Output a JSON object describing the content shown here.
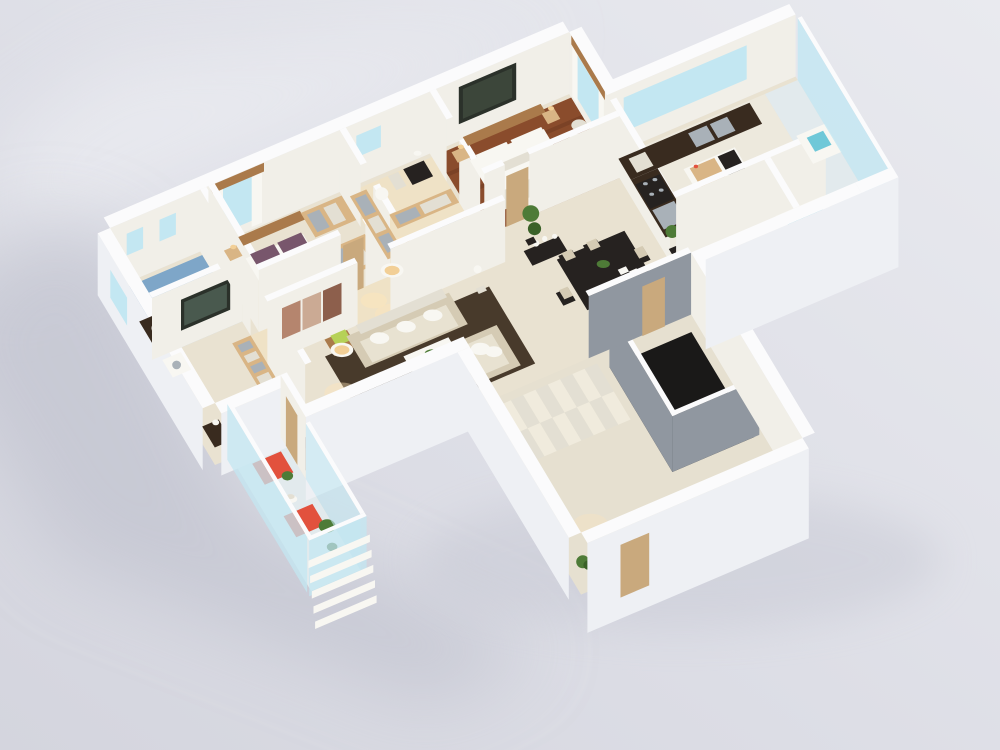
{
  "scene": {
    "kind": "3d-floorplan-render",
    "palette": {
      "bg_light": "#e9eaef",
      "bg_mid": "#dddee6",
      "bg_dark": "#d4d5de",
      "shadow": "#bec0cc",
      "light_wedge": "#f0f1f5",
      "wall_top": "#fbfbfc",
      "wall_in": "#f1efe8",
      "wall_ext": "#eef0f4",
      "wall_gray": "#9097a0",
      "floor_cream": "#e9e2d1",
      "floor_warm": "#efe2c6",
      "floor_white": "#ede9dd",
      "floor_wood": "#8a4c2c",
      "floor_wood_dk": "#7b4226",
      "floor_blue": "#7ea6c8",
      "floor_marble": "#e6e0d0",
      "floor_pale": "#e2eaed",
      "marble2": "#f0ebdd",
      "rug": "#483a2b",
      "void": "#1a1918",
      "glass": "#c3e7f2",
      "glass_deep": "#6fc8d8",
      "cyan": "#9adde6",
      "wood": "#d9b585",
      "wood_dark": "#aa7a4b",
      "counter": "#392b1f",
      "dark": "#262220",
      "brown": "#5d4634",
      "sofa": "#e8e2d1",
      "sofa_sh": "#d5cbb4",
      "white": "#f8f7f2",
      "white_sh": "#e3dfd3",
      "red": "#e2513d",
      "plant": "#4e7b37",
      "plant_dk": "#3a6128",
      "lime": "#b6d157",
      "purple": "#78566c",
      "door": "#c9a97d",
      "metal": "#a9b1b8",
      "art": "#2b312a",
      "art_in": "#3c463a",
      "art_red1": "#b5856e",
      "art_red2": "#cbaa94",
      "art_red3": "#8d5f4c",
      "warm": "#f2cf96",
      "glow": "#ffe6b8",
      "tv": "#49594e"
    },
    "items": [
      {
        "name": "floor-slab",
        "color": "floor_cream"
      },
      {
        "name": "bath-floor",
        "color": "floor_blue"
      },
      {
        "name": "roomB-floor",
        "color": "floor_cream"
      },
      {
        "name": "bedroom2-floor",
        "color": "floor_cream"
      },
      {
        "name": "closet-floor",
        "color": "floor_warm"
      },
      {
        "name": "master-floor",
        "color": "floor_wood"
      },
      {
        "name": "corridor-floor",
        "color": "floor_warm"
      },
      {
        "name": "living-floor",
        "color": "floor_cream"
      },
      {
        "name": "dining-floor",
        "color": "floor_cream"
      },
      {
        "name": "kitchen-floor",
        "color": "floor_white"
      },
      {
        "name": "rbath-floor",
        "color": "floor_white"
      },
      {
        "name": "gallery-floor",
        "color": "floor_pale"
      },
      {
        "name": "stair-floor",
        "color": "floor_marble"
      },
      {
        "name": "balcony-floor",
        "color": "floor_pale"
      },
      {
        "name": "living-rug",
        "color": "rug"
      },
      {
        "name": "stair-void",
        "color": "void"
      },
      {
        "name": "glow-set",
        "color": "glow"
      },
      {
        "name": "wall-back",
        "color": "wall_in"
      },
      {
        "name": "win-bath-1",
        "color": "glass"
      },
      {
        "name": "win-bath-2",
        "color": "glass"
      },
      {
        "name": "win-bedroom2",
        "color": "glass"
      },
      {
        "name": "win-closet",
        "color": "glass"
      },
      {
        "name": "art-master",
        "color": "art"
      },
      {
        "name": "wall-jog",
        "color": "wall_in"
      },
      {
        "name": "win-master",
        "color": "glass"
      },
      {
        "name": "wall-back-kitchen",
        "color": "wall_in"
      },
      {
        "name": "win-kitchen",
        "color": "glass"
      },
      {
        "name": "wall-left-ext",
        "color": "wall_ext"
      },
      {
        "name": "win-left",
        "color": "glass"
      },
      {
        "name": "wall-kitchen-divider",
        "color": "wall_in"
      },
      {
        "name": "toilet-bath",
        "color": "white"
      },
      {
        "name": "vanity-bath",
        "color": "counter"
      },
      {
        "name": "wall-bath-right",
        "color": "wall_in"
      },
      {
        "name": "wall-bath-front",
        "color": "wall_in"
      },
      {
        "name": "tv-roomB",
        "color": "art"
      },
      {
        "name": "cabinet-roomB",
        "color": "wood"
      },
      {
        "name": "washer-roomB",
        "color": "white"
      },
      {
        "name": "sideboard-roomB",
        "color": "counter"
      },
      {
        "name": "wall-roomB-right",
        "color": "wall_in"
      },
      {
        "name": "wall-bedroom2-left",
        "color": "wall_in"
      },
      {
        "name": "bed-bedroom2",
        "color": "white"
      },
      {
        "name": "nightstand-bedroom2",
        "color": "wood"
      },
      {
        "name": "wardrobe-bedroom2",
        "color": "wood"
      },
      {
        "name": "wall-bedroom2-front",
        "color": "wall_in"
      },
      {
        "name": "door-bedroom2",
        "color": "door"
      },
      {
        "name": "wall-closet-left",
        "color": "wall_in"
      },
      {
        "name": "wardrobe-closet-1",
        "color": "wood"
      },
      {
        "name": "wardrobe-closet-2",
        "color": "wood"
      },
      {
        "name": "wardrobe-closet-3",
        "color": "wood"
      },
      {
        "name": "toilet-closet",
        "color": "white"
      },
      {
        "name": "cabinet-closet",
        "color": "dark"
      },
      {
        "name": "wall-closet-right",
        "color": "wall_in"
      },
      {
        "name": "bed-master",
        "color": "white"
      },
      {
        "name": "nightstand-master-1",
        "color": "wood"
      },
      {
        "name": "nightstand-master-2",
        "color": "wood"
      },
      {
        "name": "chair-master",
        "color": "white"
      },
      {
        "name": "ottoman-master",
        "color": "white"
      },
      {
        "name": "wall-master-front",
        "color": "wall_in"
      },
      {
        "name": "door-master",
        "color": "door"
      },
      {
        "name": "wardrobe-corridor",
        "color": "wood"
      },
      {
        "name": "wall-living-back",
        "color": "wall_in"
      },
      {
        "name": "art-living",
        "color": "art_red1"
      },
      {
        "name": "lamp-living-2",
        "color": "white"
      },
      {
        "name": "side-table-living",
        "color": "wood_dark"
      },
      {
        "name": "sofa-main",
        "color": "sofa"
      },
      {
        "name": "armchair-1",
        "color": "sofa"
      },
      {
        "name": "armchair-2",
        "color": "sofa"
      },
      {
        "name": "coffee-table",
        "color": "white"
      },
      {
        "name": "lamp-living-1",
        "color": "white"
      },
      {
        "name": "statue-living",
        "color": "white"
      },
      {
        "name": "nook-sofa",
        "color": "brown"
      },
      {
        "name": "console-dining",
        "color": "dark"
      },
      {
        "name": "plant-dining",
        "color": "plant"
      },
      {
        "name": "dining-table",
        "color": "dark"
      },
      {
        "name": "chairs-dining",
        "color": "dark"
      },
      {
        "name": "counter-kitchen-back",
        "color": "counter"
      },
      {
        "name": "counter-kitchen-left",
        "color": "counter"
      },
      {
        "name": "island-kitchen",
        "color": "white"
      },
      {
        "name": "plant-kitchen",
        "color": "plant"
      },
      {
        "name": "wall-rbath-back",
        "color": "wall_in"
      },
      {
        "name": "vanity-rbath",
        "color": "white"
      },
      {
        "name": "mat-rbath",
        "color": "cyan"
      },
      {
        "name": "wall-rbath-div",
        "color": "wall_in"
      },
      {
        "name": "tub-rbath",
        "color": "white"
      },
      {
        "name": "shelf-gallery",
        "color": "white"
      },
      {
        "name": "glass-gallery",
        "color": "glass"
      },
      {
        "name": "stair-steps",
        "color": "floor_marble"
      },
      {
        "name": "plant-stair",
        "color": "plant"
      },
      {
        "name": "wall-void-left",
        "color": "wall_gray"
      },
      {
        "name": "wall-void-bottom",
        "color": "wall_gray"
      },
      {
        "name": "wall-stair-divider",
        "color": "wall_gray"
      },
      {
        "name": "door-stair-hall",
        "color": "door"
      },
      {
        "name": "wall-stair-right",
        "color": "wall_in"
      },
      {
        "name": "facade-roomB-front",
        "color": "wall_ext"
      },
      {
        "name": "wall-nook",
        "color": "wall_in"
      },
      {
        "name": "door-nook",
        "color": "door"
      },
      {
        "name": "facade-living-front",
        "color": "wall_ext"
      },
      {
        "name": "facade-stair-left",
        "color": "wall_ext"
      },
      {
        "name": "facade-stair-front",
        "color": "wall_ext"
      },
      {
        "name": "door-front",
        "color": "door"
      },
      {
        "name": "facade-right-wing",
        "color": "wall_ext"
      },
      {
        "name": "facade-gallery-end",
        "color": "wall_ext"
      },
      {
        "name": "seat-balcony-1",
        "color": "red"
      },
      {
        "name": "seat-balcony-2",
        "color": "red"
      },
      {
        "name": "table-balcony",
        "color": "white"
      },
      {
        "name": "plant-balcony-1",
        "color": "plant"
      },
      {
        "name": "plant-balcony-2",
        "color": "plant"
      },
      {
        "name": "glass-balcony-left",
        "color": "glass"
      },
      {
        "name": "glass-balcony-right",
        "color": "glass"
      },
      {
        "name": "glass-balcony-front",
        "color": "glass"
      },
      {
        "name": "louvers-balcony",
        "color": "white"
      }
    ]
  }
}
